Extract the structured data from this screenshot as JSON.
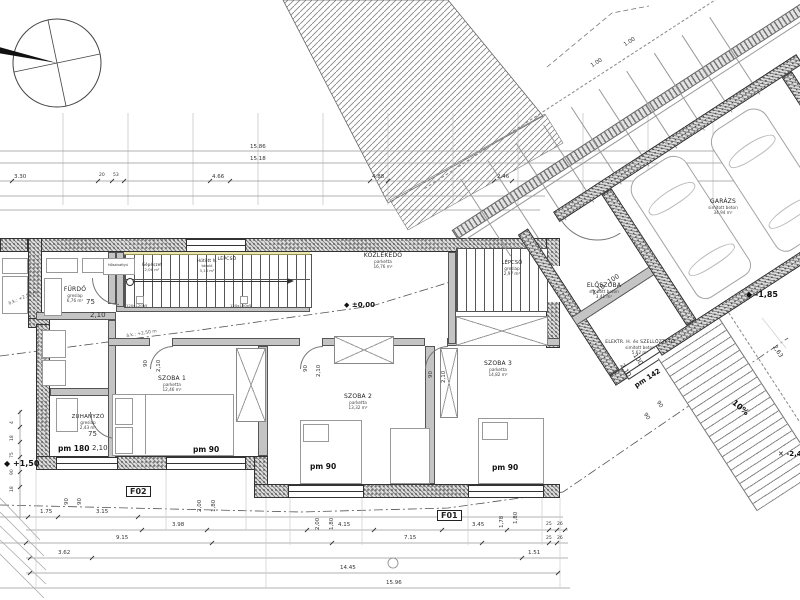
{
  "rooms": [
    {
      "name": "FÜRDŐ",
      "finish": "greslap",
      "area": "6,76 m²"
    },
    {
      "name": "ZUHANYZÓ",
      "finish": "greslap",
      "area": "2,43 m²"
    },
    {
      "name": "KÖZLEKEDŐ",
      "finish": "parketta",
      "area": "16,76 m²"
    },
    {
      "name": "LÉPCSŐ",
      "finish": "",
      "area": ""
    },
    {
      "name": "LÉPCSŐ",
      "finish": "greslap",
      "area": "2,97 m²"
    },
    {
      "name": "SZOBA 1",
      "finish": "parketta",
      "area": "12,46 m²"
    },
    {
      "name": "SZOBA 2",
      "finish": "parketta",
      "area": "13,32 m²"
    },
    {
      "name": "SZOBA 3",
      "finish": "parketta",
      "area": "14,82 m²"
    },
    {
      "name": "ELŐSZOBA",
      "finish": "simított beton",
      "area": "3,41 m²"
    },
    {
      "name": "ELEKTR. H. és SZELLŐZTETŐ",
      "finish": "simított beton",
      "area": "5,62 m²"
    },
    {
      "name": "GARÁZS",
      "finish": "simított beton",
      "area": "34,94 m²"
    },
    {
      "name": "Hűtött h.",
      "finish": "tároló",
      "area": "3,16 m²"
    },
    {
      "name": "Gépészet",
      "finish": "",
      "area": "2,06 m²"
    },
    {
      "name": "Hőszivattyú",
      "finish": "",
      "area": ""
    }
  ],
  "doors": {
    "furdo": {
      "w": "75",
      "h": "2,10"
    },
    "zuhanyzo": {
      "w": "75",
      "h": "2,10"
    },
    "szoba1": {
      "w": "90",
      "h": "2,10"
    },
    "szoba2": {
      "w": "90",
      "h": "2,10"
    },
    "szoba3": {
      "w": "90",
      "h": "2,10"
    },
    "eloszoba": {
      "w": "100",
      "h": "2,10"
    },
    "garazs": {
      "w": "100",
      "h": "2,10"
    }
  },
  "windows": {
    "w180": {
      "label": "pm 180"
    },
    "w90a": {
      "label": "pm 90",
      "w": "2,00",
      "h": "1,80"
    },
    "w90b": {
      "label": "pm 90",
      "w": "2,00",
      "h": "1,80"
    },
    "w90c": {
      "label": "pm 90",
      "w": "1,78",
      "h": "1,80"
    },
    "w142": {
      "label": "pm 142"
    }
  },
  "levels": {
    "entry": "+1,50",
    "corridor": "±0,00",
    "garage": "-1,85",
    "ramp_end": "-2,45"
  },
  "sections": {
    "f01": "F01",
    "f02": "F02"
  },
  "annotations": {
    "slope": "10%",
    "post1": "120x120x5",
    "post2": "120x120x5",
    "eaves1": "ö.k.: +2,50 m",
    "eaves2": "á.k.: +2,50 m",
    "d263": "2,63"
  },
  "dims": {
    "top": [
      "3.30",
      "20",
      "53",
      "4.66",
      "4.88",
      "2.46",
      "15.86",
      "15.18",
      "1.00",
      "1.00"
    ],
    "b1": [
      "1.75",
      "3.15"
    ],
    "b2": [
      "3.98",
      "4.15",
      "3.45",
      "25",
      "26"
    ],
    "b3": [
      "9.15",
      "7.15",
      "25",
      "26"
    ],
    "b4": [
      "3.62",
      "1.51"
    ],
    "b5": [
      "14.45"
    ],
    "b6": [
      "15.96"
    ],
    "left": [
      "4",
      "18",
      "75",
      "90",
      "18"
    ],
    "lb": [
      "90",
      "90"
    ],
    "ramp": [
      "90",
      "90"
    ]
  }
}
